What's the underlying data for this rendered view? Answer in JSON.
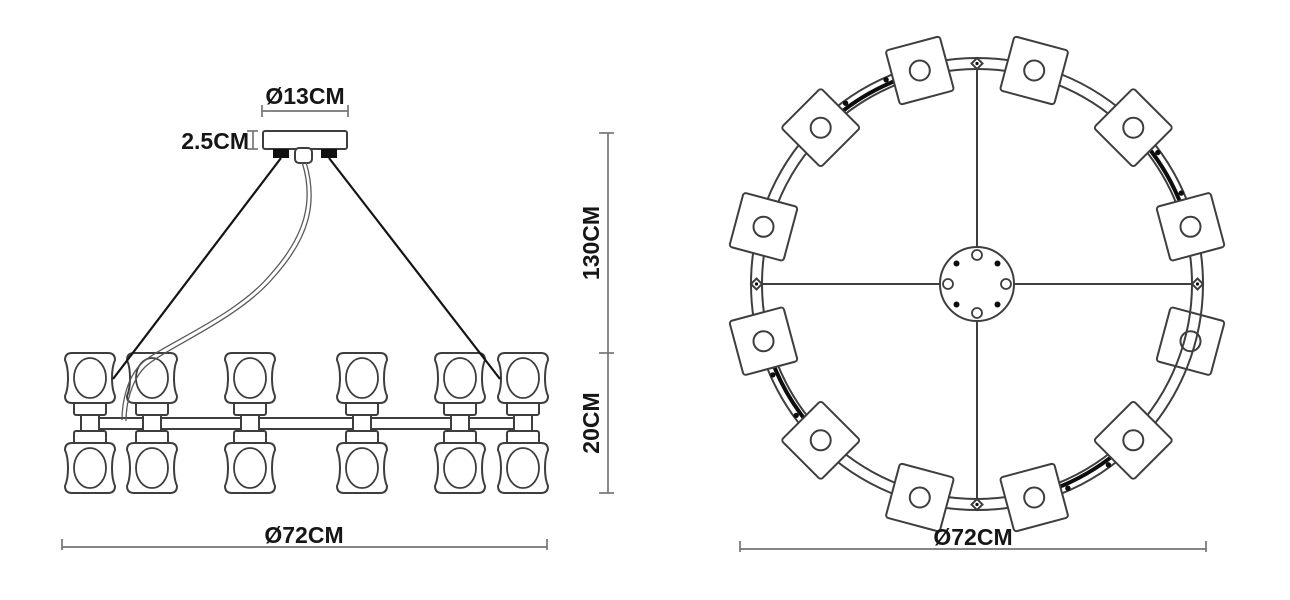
{
  "labels": {
    "canopy_diameter": "Ø13CM",
    "canopy_height": "2.5CM",
    "suspension_height": "130CM",
    "body_height": "20CM",
    "side_width": "Ø72CM",
    "plan_diameter": "Ø72CM"
  },
  "colors": {
    "line": "#3e3e3e",
    "dimension": "#757575",
    "cable": "#141414",
    "text": "#161616",
    "background": "#ffffff"
  },
  "geometry": {
    "side": {
      "column_centers": [
        90,
        152,
        250,
        362,
        460,
        523
      ],
      "head_size": 50,
      "top_head_y": 353,
      "bottom_head_y": 443,
      "bar": {
        "x": 88,
        "y": 418,
        "w": 442,
        "h": 11
      }
    },
    "plan": {
      "cx": 977,
      "cy": 284,
      "ring_outer_r": 226,
      "ring_inner_r": 215,
      "lamp_radius": 221,
      "lamp_size": 56,
      "lamp_hole_r": 10,
      "lamp_angles": [
        15,
        45,
        75,
        105,
        135,
        165,
        195,
        225,
        255,
        285,
        315,
        345
      ],
      "under_ring_angle": 105,
      "cable_arc_angles": [
        60,
        150,
        240,
        330
      ],
      "spoke_angles": [
        0,
        90,
        180,
        270
      ],
      "hub_r": 37,
      "hub_mark_r": 29
    }
  }
}
